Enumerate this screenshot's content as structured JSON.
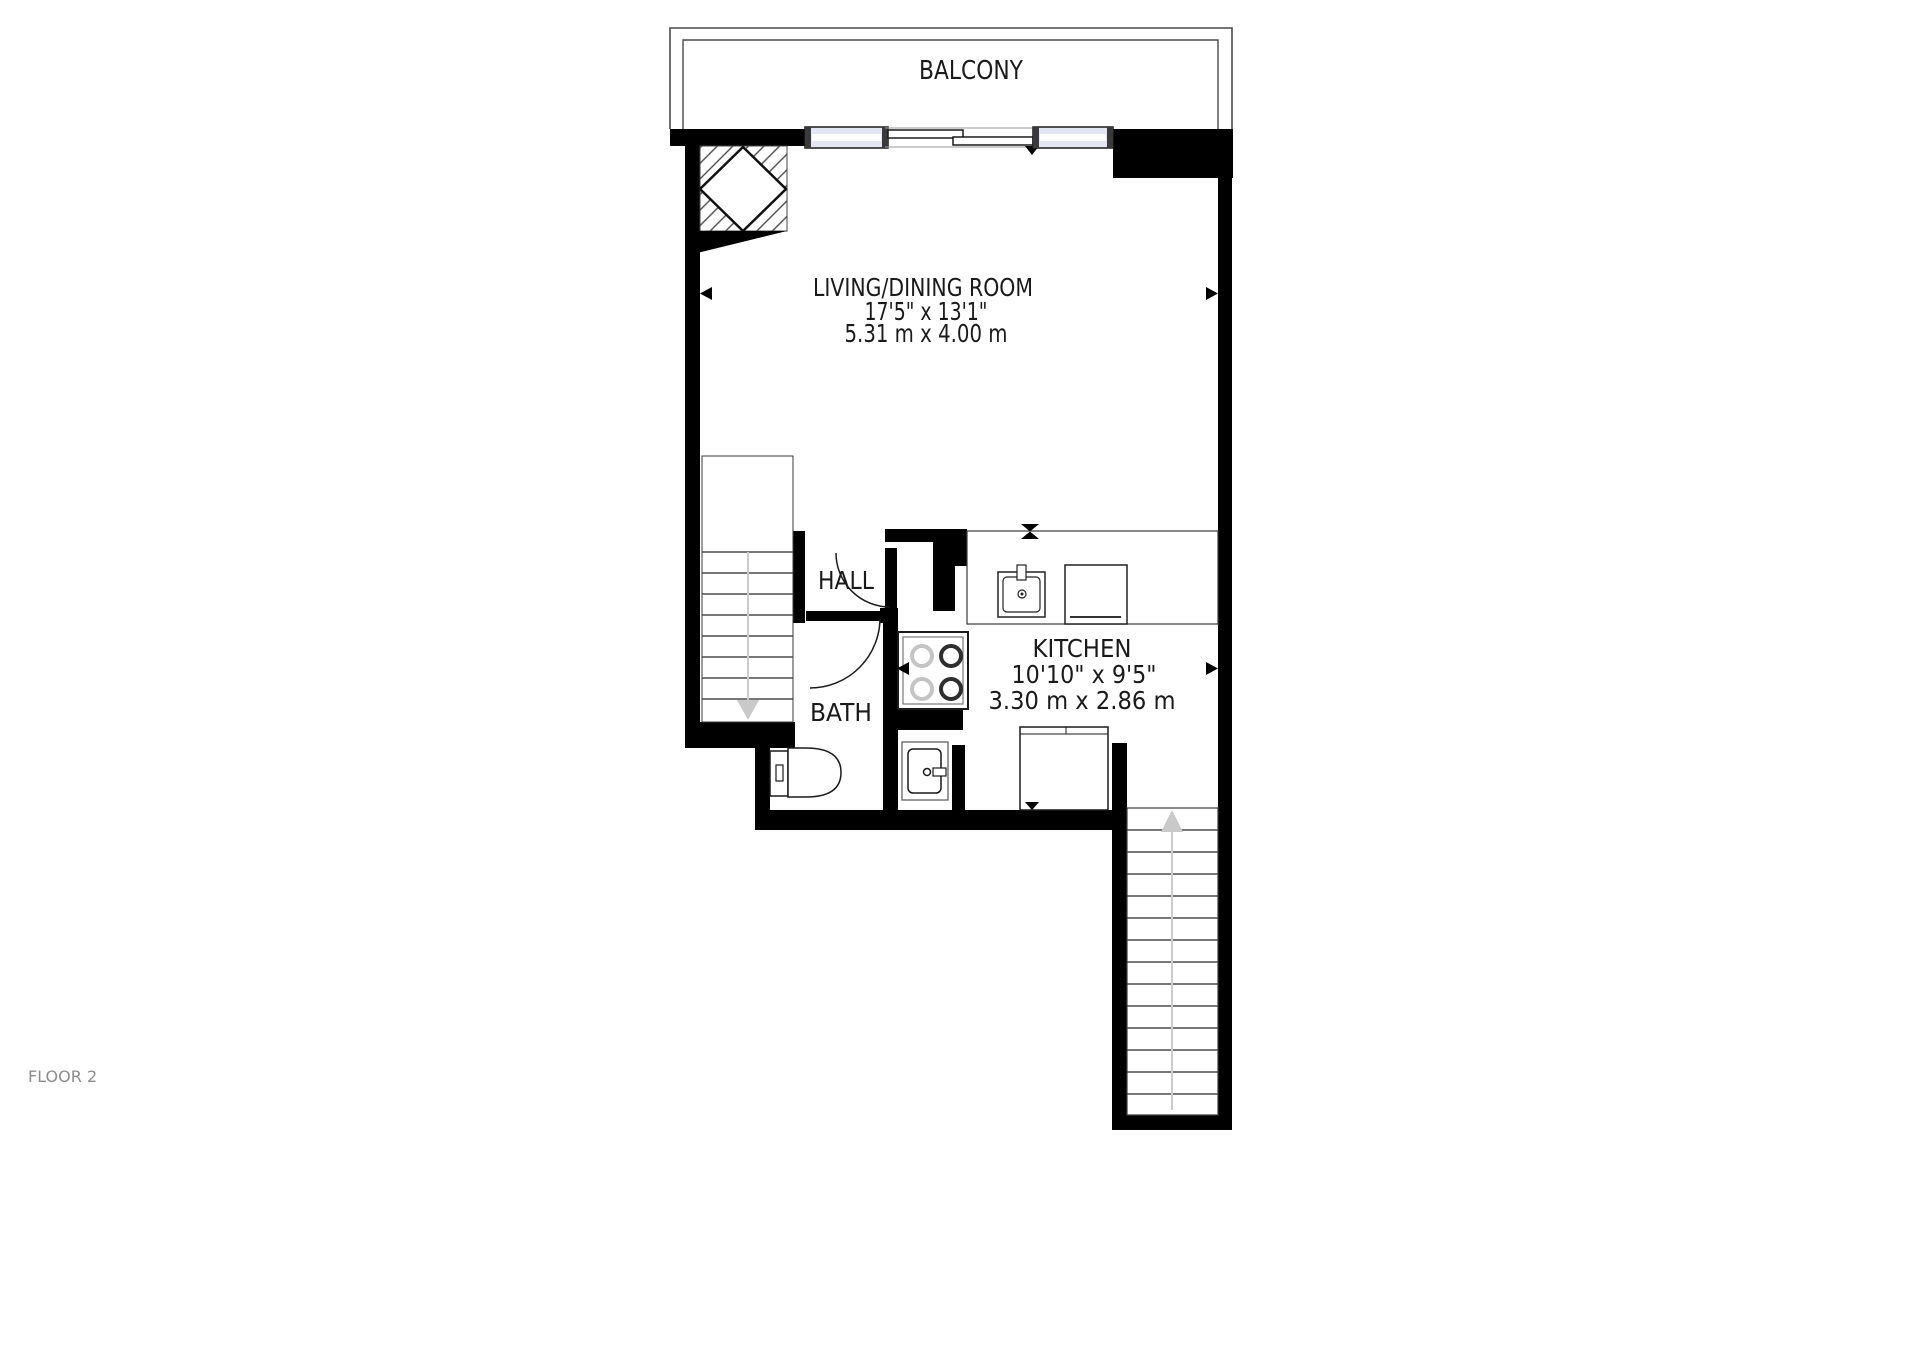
{
  "floor_label": "FLOOR 2",
  "rooms": {
    "balcony": {
      "label": "BALCONY"
    },
    "living_dining": {
      "label": "LIVING/DINING ROOM",
      "size_imperial": "17'5\" x 13'1\"",
      "size_metric": "5.31 m x 4.00 m"
    },
    "hall": {
      "label": "HALL"
    },
    "bath": {
      "label": "BATH"
    },
    "kitchen": {
      "label": "KITCHEN",
      "size_imperial": "10'10\" x 9'5\"",
      "size_metric": "3.30 m x 2.86 m"
    }
  },
  "colors": {
    "background": "#ffffff",
    "walls": "#000000",
    "window_fill": "#e4e6f5",
    "balcony_outline": "#4a4a4a",
    "stair_tread": "#4a4a4a",
    "stair_arrow": "#c9c9c9",
    "label_text": "#1a1a1a",
    "floor_label_text": "#8c8c8c"
  }
}
